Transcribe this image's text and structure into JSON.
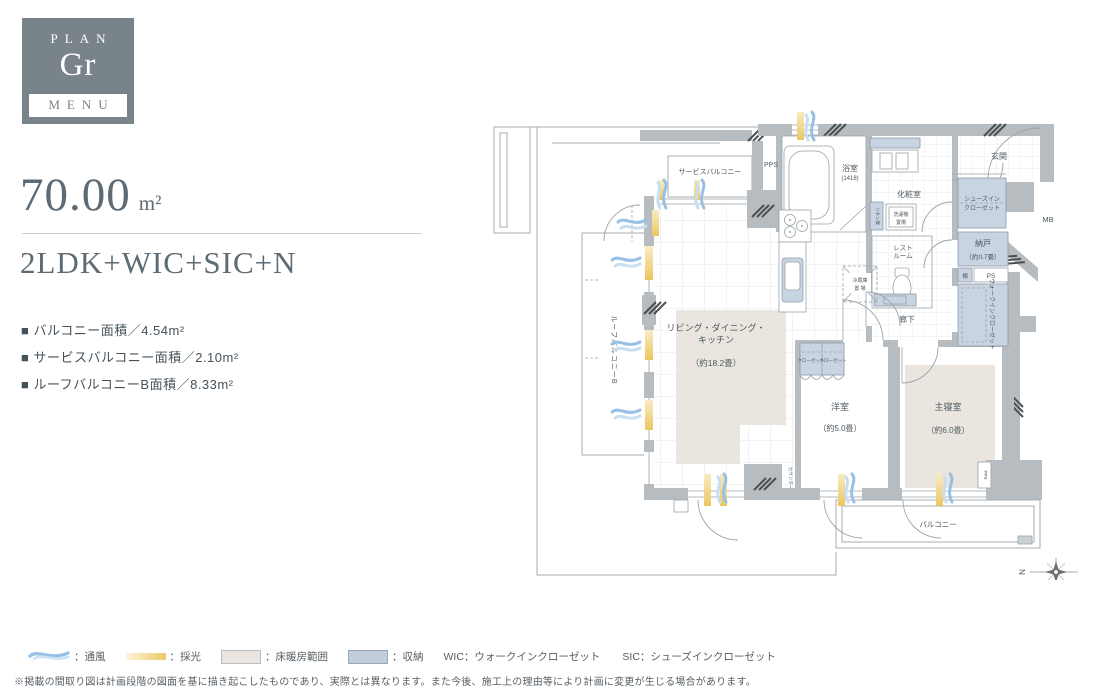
{
  "colors": {
    "accent": "#78838a",
    "storage": "#c9d4e2",
    "floor_heating": "#eae6df",
    "vent_blue": "#97c0e4",
    "light_yellow": "#ecc969"
  },
  "badge": {
    "plan_label": "PLAN",
    "plan_code": "Gr",
    "menu_label": "MENU"
  },
  "summary": {
    "area_value": "70.00",
    "area_unit": "m²",
    "layout": "2LDK+WIC+SIC+N",
    "details": [
      "■ バルコニー面積／4.54m²",
      "■ サービスバルコニー面積／2.10m²",
      "■ ルーフバルコニーB面積／8.33m²"
    ]
  },
  "plan": {
    "service_balcony": "サービスバルコニー",
    "pps": "PPS",
    "pps_small": "PPS",
    "bath": "浴室",
    "bath_size": "(1418)",
    "powder_room": "化粧室",
    "linen": "リネン庫",
    "washer_l1": "洗濯機",
    "washer_l2": "置場",
    "entrance": "玄関",
    "sic_l1": "シューズイン",
    "sic_l2": "クローゼット",
    "mb": "MB",
    "storeroom": "納戸",
    "storeroom_size": "（約0.7畳）",
    "shelf": "棚",
    "ps": "PS",
    "wic": "ウォークインクローゼット",
    "corridor": "廊下",
    "restroom_l1": "レスト",
    "restroom_l2": "ルーム",
    "fridge_l1": "冷蔵庫",
    "fridge_l2": "置 場",
    "ldk_l1": "リビング・ダイニング・",
    "ldk_l2": "キッチン",
    "ldk_size": "（約18.2畳）",
    "western_room": "洋室",
    "western_room_size": "（約5.0畳）",
    "main_bedroom": "主寝室",
    "main_bedroom_size": "（約6.0畳）",
    "closet": "クローゼット",
    "counter": "カウンター",
    "balcony": "バルコニー",
    "roof_balcony": "ルーフバルコニーB",
    "north": "N"
  },
  "legend": {
    "vent_label": "：通風",
    "light_label": "：採光",
    "heating_label": "：床暖房範囲",
    "storage_label": "：収納",
    "wic_note": "WIC：ウォークインクローゼット",
    "sic_note": "SIC：シューズインクローゼット"
  },
  "disclaimer": "※掲載の間取り図は計画段階の図面を基に描き起こしたものであり、実際とは異なります。また今後、施工上の理由等により計画に変更が生じる場合があります。"
}
